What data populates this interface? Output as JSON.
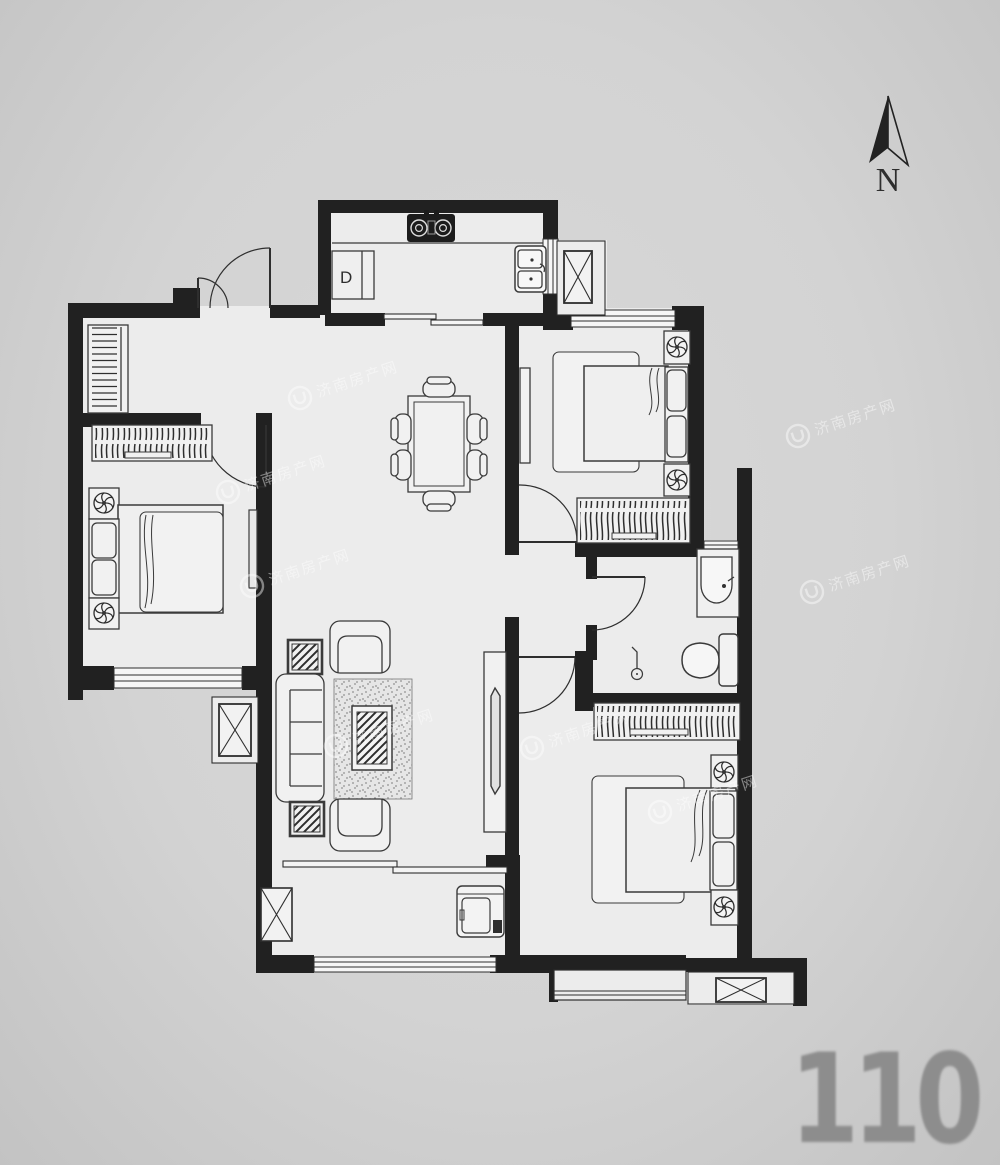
{
  "compass": {
    "label": "N"
  },
  "area_badge": {
    "value": "110"
  },
  "kitchen": {
    "appliance_label": "D"
  },
  "watermark": {
    "text": "济南房产网"
  },
  "colors": {
    "background": "#d3d3d3",
    "wall": "#212121",
    "floor": "#ececec",
    "furniture_stroke": "#3a3a3a",
    "area_badge": "#8d8d8d"
  }
}
